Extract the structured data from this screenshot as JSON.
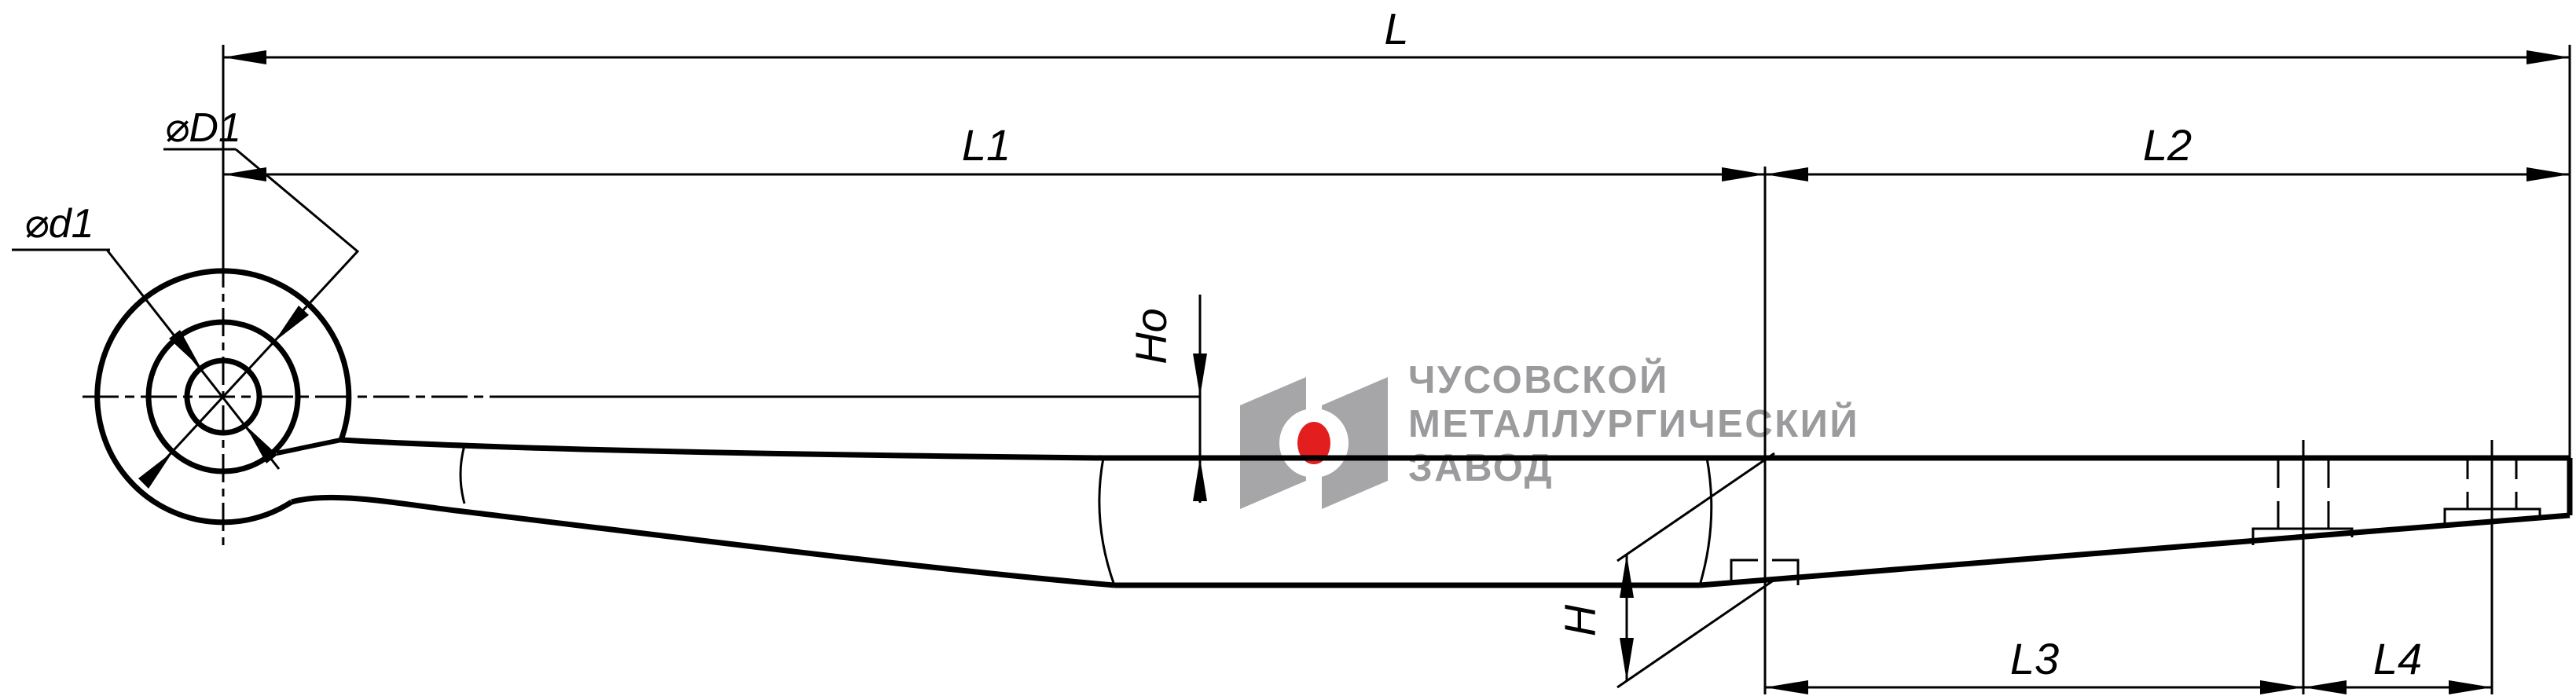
{
  "drawing": {
    "type": "leaf-spring engineering drawing",
    "dimension_labels": {
      "overall_length": "L",
      "front_segment": "L1",
      "rear_segment": "L2",
      "clip_segment_1": "L3",
      "clip_segment_2": "L4",
      "center_thickness": "H",
      "camber_height": "Ho",
      "eye_inner_diameter": "⌀d1",
      "eye_wrap_diameter": "⌀D1"
    },
    "logo": {
      "line1": "ЧУСОВСКОЙ",
      "line2": "МЕТАЛЛУРГИЧЕСКИЙ",
      "line3": "ЗАВОД",
      "text_color": "#9b9b9d",
      "emblem_gray": "#a6a6a8",
      "emblem_red": "#e31e1e"
    },
    "colors": {
      "line": "#000000",
      "background": "#ffffff"
    }
  }
}
